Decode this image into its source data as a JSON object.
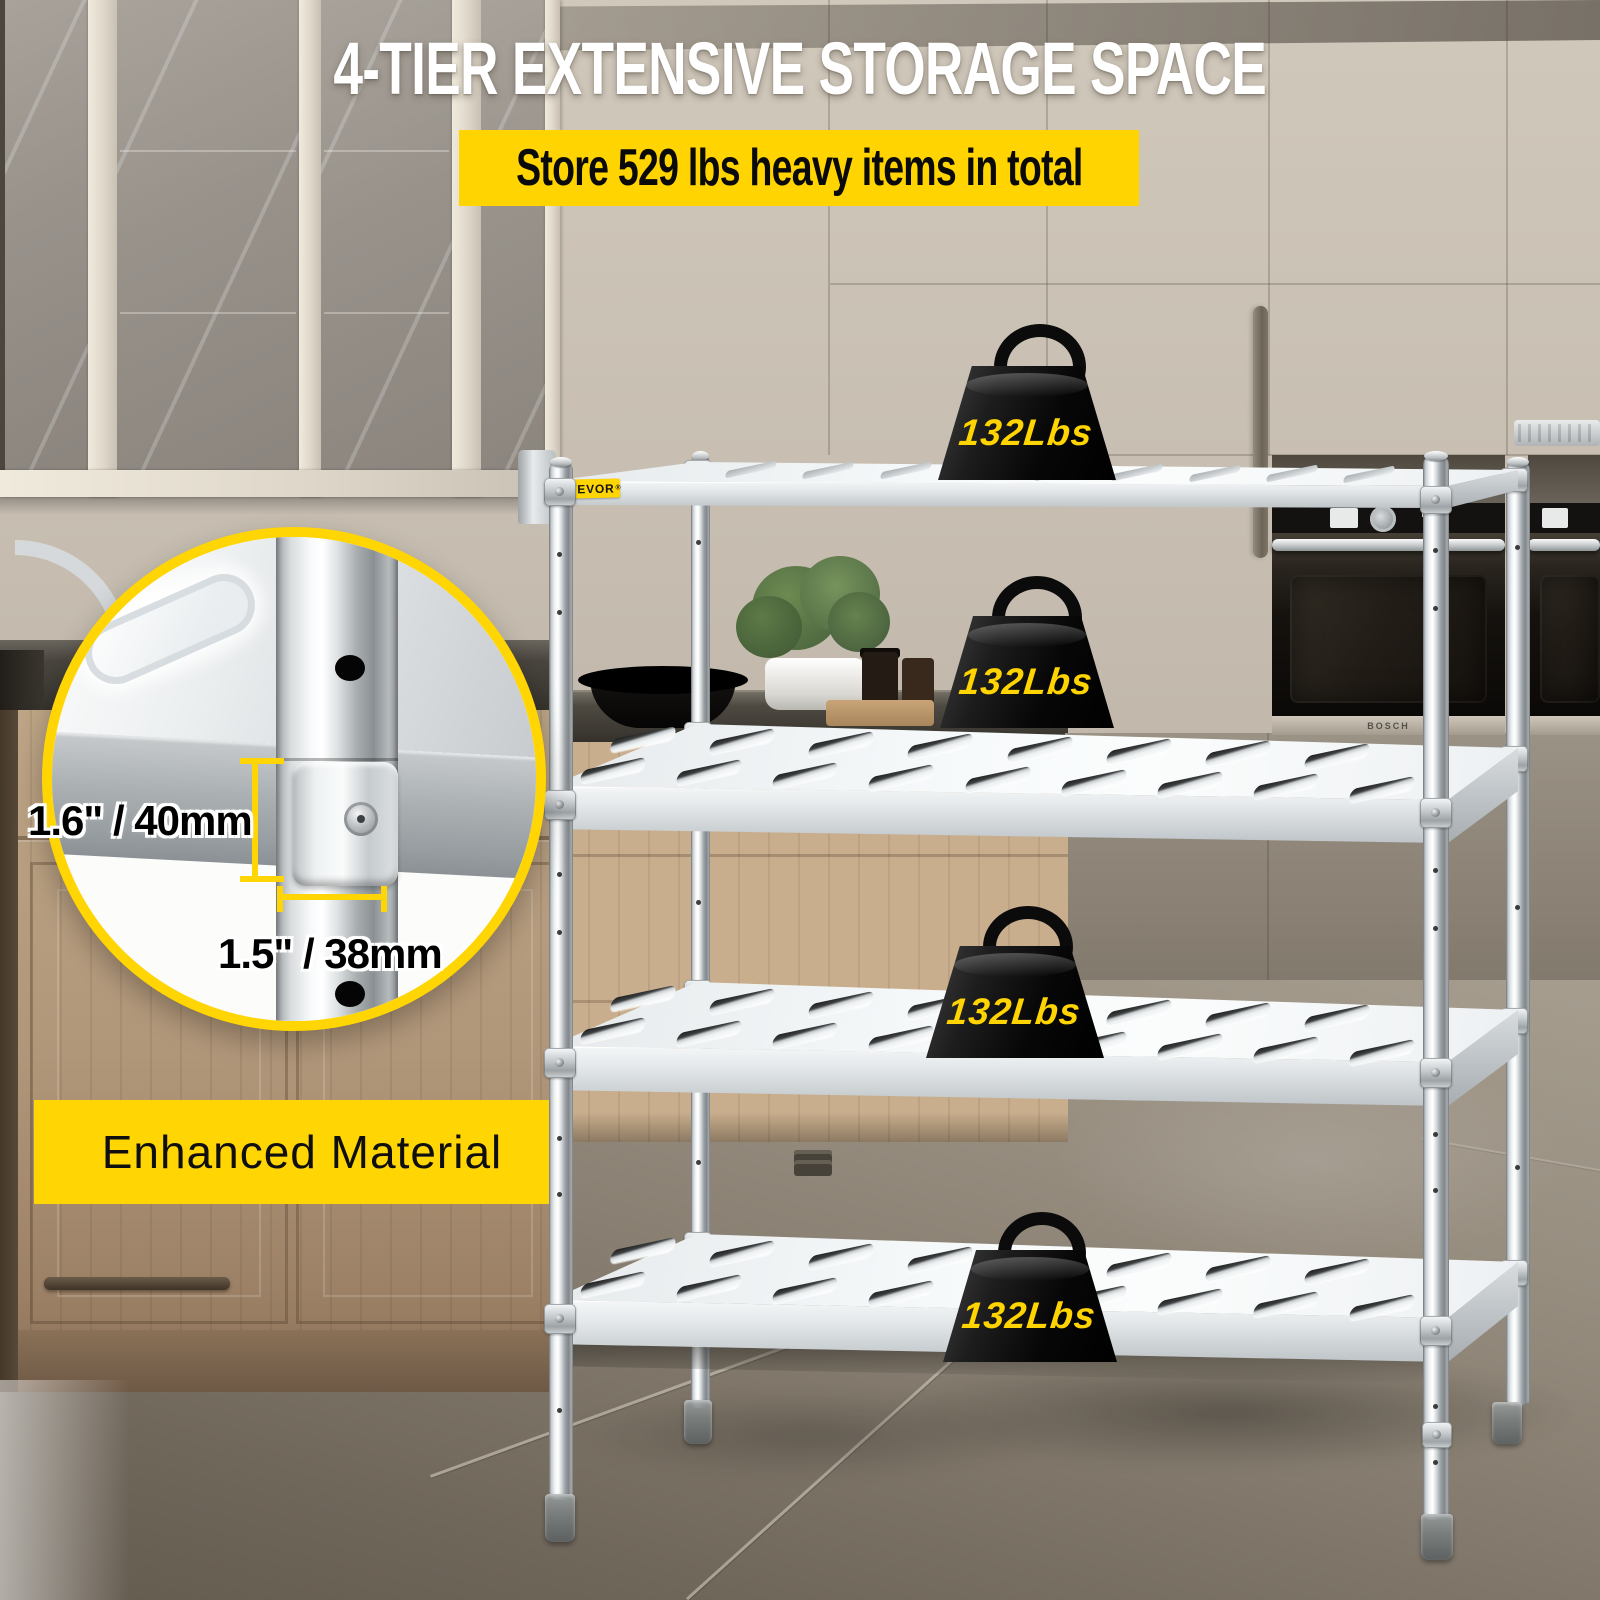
{
  "header": {
    "title": "4-TIER EXTENSIVE STORAGE SPACE",
    "banner": "Store 529 lbs heavy items in total"
  },
  "brand_badge": {
    "name": "VEVOR",
    "registered": "®"
  },
  "weights": [
    "132Lbs",
    "132Lbs",
    "132Lbs",
    "132Lbs"
  ],
  "inset": {
    "shelf_thickness": "1.6\" / 40mm",
    "pole_diameter": "1.5\" / 38mm"
  },
  "material_banner": "Enhanced Material",
  "appliance": {
    "brand": "BOSCH"
  },
  "colors": {
    "accent_yellow": "#FFD503",
    "weight_label_yellow": "#FFD400",
    "banner_text": "#0A0A0A",
    "title_white": "#FFFFFF"
  }
}
